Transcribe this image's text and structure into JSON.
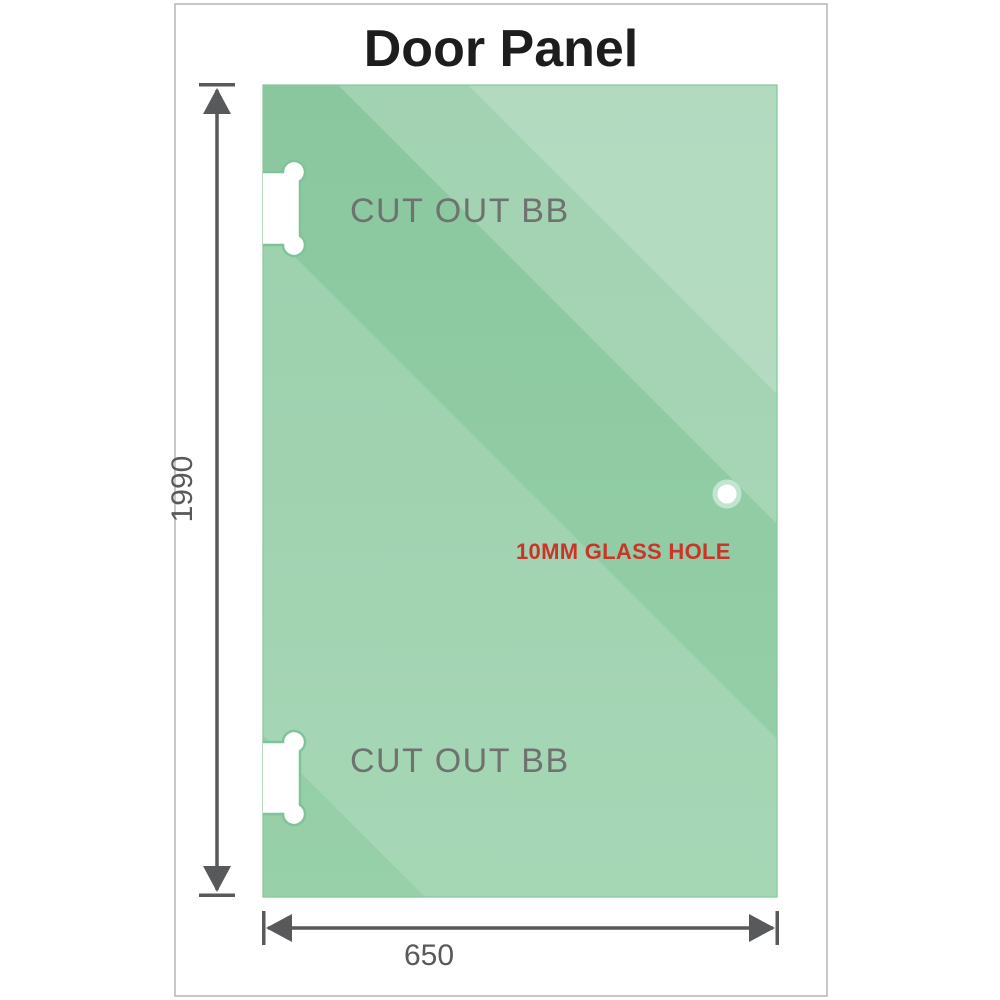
{
  "title": "Door Panel",
  "panel": {
    "cutouts": [
      {
        "position": "top",
        "label": "CUT OUT BB"
      },
      {
        "position": "bottom",
        "label": "CUT OUT BB"
      }
    ],
    "hole": {
      "label": "10MM GLASS HOLE"
    }
  },
  "dimensions": {
    "height": "1990",
    "width": "650"
  },
  "colors": {
    "title": "#1d1d1d",
    "frame_border": "#b3b6b8",
    "glass_base_top": "#8ac79e",
    "glass_base_bottom": "#97d0a9",
    "glass_edge": "#7fc399",
    "cutout_label": "#6e7370",
    "hole_label": "#cd3429",
    "dimension": "#58595b"
  }
}
